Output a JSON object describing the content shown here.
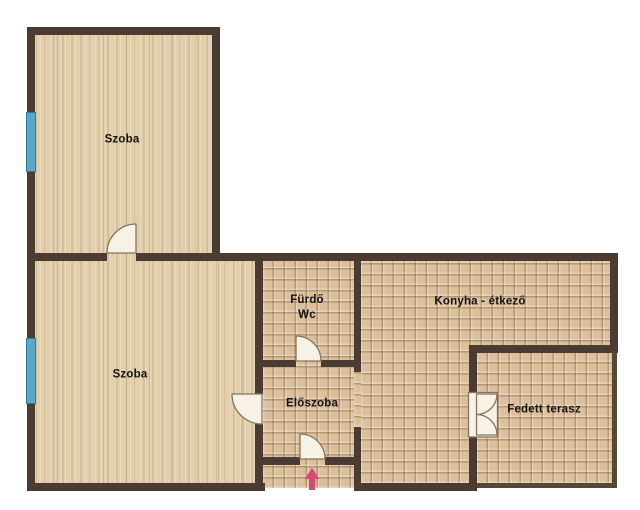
{
  "plan": {
    "rooms": {
      "szoba_top": "Szoba",
      "szoba_bottom": "Szoba",
      "furdo_line1": "Fürdő",
      "furdo_line2": "Wc",
      "konyha": "Konyha - étkező",
      "eloszoba": "Előszoba",
      "terasz": "Fedett terasz"
    },
    "colors": {
      "wall": "#4a3c33",
      "wood_floor": "#e3cfab",
      "tile_floor": "#dcbf9b",
      "window_blue": "#58a8cb",
      "door_leaf": "#f7f2e6",
      "entrance_arrow": "#d64b70",
      "background": "#ffffff",
      "label_text": "#141414"
    },
    "icons": {
      "entrance_arrow": "arrow-up-icon"
    }
  }
}
